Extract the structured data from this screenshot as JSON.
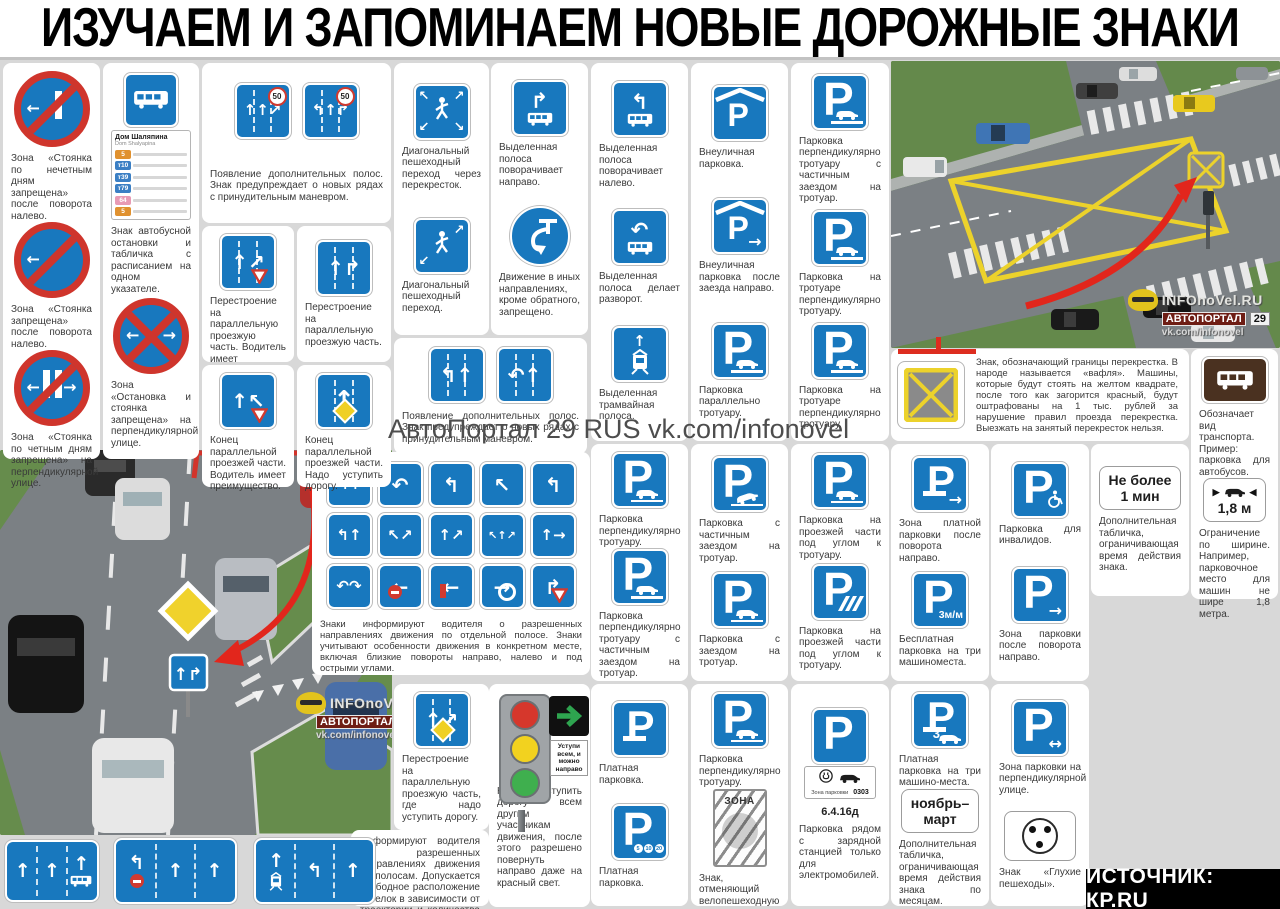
{
  "title": "ИЗУЧАЕМ И ЗАПОМИНАЕМ НОВЫЕ ДОРОЖНЫЕ ЗНАКИ",
  "source_bar": "ИСТОЧНИК: КР.RU",
  "watermark": {
    "brand": "АвтоПортал 29 RUS vk.com/infonovel"
  },
  "photo_watermark": {
    "line1": "INFOnoVel.RU",
    "chip1": "АВТОПОРТАЛ",
    "chip2": "29",
    "line3": "vk.com/infonovel"
  },
  "colors": {
    "sign_blue": "#1878be",
    "sign_red": "#cf352c",
    "waffle_yellow": "#ecd22b",
    "background": "#d8d8d8"
  },
  "bus_stop": {
    "title": "Дом Шаляпина",
    "subtitle": "Dom Shalyapina",
    "routes": [
      {
        "label": "5",
        "color": "#e0912f"
      },
      {
        "label": "т10",
        "color": "#3b7fc4"
      },
      {
        "label": "т39",
        "color": "#3b7fc4"
      },
      {
        "label": "т79",
        "color": "#3b7fc4"
      },
      {
        "label": "64",
        "color": "#e89ab4"
      },
      {
        "label": "5",
        "color": "#e0912f"
      }
    ]
  },
  "texts": {
    "waffle": "Знак, обозначающий границы перекрестка. В народе называется «вафля». Машины, которые будут стоять на желтом квадрате, после того как загорится красный, будут оштрафованы на 1 тыс. рублей за нарушение правил проезда перекрестка. Выезжать на занятый перекресток нельзя.",
    "lane_info": "Информируют водителя о разрешенных направлениях движения по полосам. Допускается свободное расположение стрелок в зависимости от траектории и количества направлений движения из полосы."
  },
  "cluster": {
    "text": "Знаки информируют водителя о разрешенных направлениях движения по отдельной полосе. Знаки учитывают особенности движения в конкретном месте, включая близкие повороты направо, налево и под острыми углами.",
    "items": [
      {
        "g": "↰↑"
      },
      {
        "g": "↶"
      },
      {
        "g": "↰"
      },
      {
        "g": "↖"
      },
      {
        "g": "↰"
      },
      {
        "g": "↰↑"
      },
      {
        "g": "↖↗"
      },
      {
        "g": "↑↗"
      },
      {
        "g": "↖↑↗"
      },
      {
        "g": "↑→"
      },
      {
        "g": "↶↷"
      },
      {
        "g": "←",
        "ex": [
          "noentry"
        ]
      },
      {
        "g": "←",
        "ex": [
          "stopbar"
        ]
      },
      {
        "g": "→",
        "ex": [
          "ring"
        ]
      },
      {
        "g": "↱",
        "ex": [
          "yield"
        ]
      }
    ]
  },
  "traffic_light": {
    "plate": "Уступи всем, и можно направо",
    "caption": "Нужно уступить дорогу всем другим участникам движения, после этого разрешено повернуть направо даже на красный свет.",
    "light_colors": [
      "#d6372c",
      "#f2d21f",
      "#3faf4e"
    ]
  },
  "bottom_signs": [
    {
      "x": 5,
      "y": 840,
      "w": 94,
      "h": 62,
      "cols": [
        {
          "g": "↑"
        },
        {
          "g": "↑"
        },
        {
          "g": "↑",
          "bus": true
        }
      ]
    },
    {
      "x": 114,
      "y": 838,
      "w": 123,
      "h": 66,
      "cols": [
        {
          "g": "↰",
          "ex": [
            "noentry"
          ]
        },
        {
          "g": "↑"
        },
        {
          "g": "↑"
        }
      ]
    },
    {
      "x": 254,
      "y": 838,
      "w": 121,
      "h": 66,
      "cols": [
        {
          "g": "↑",
          "tram": true
        },
        {
          "g": "↰"
        },
        {
          "g": "↑"
        }
      ]
    }
  ],
  "cards": [
    {
      "id": "zone-parking-left",
      "x": 3,
      "y": 63,
      "w": 97,
      "h": 396,
      "items": [
        {
          "kind": "round",
          "bars": 1,
          "arrows": "l",
          "name": "no-parking-odd-days-sign",
          "caption": "Зона «Стоянка по нечетным дням запрещена» после поворота налево."
        },
        {
          "kind": "round",
          "bars": 0,
          "arrows": "l",
          "name": "no-parking-sign",
          "caption": "Зона «Стоянка запрещена» после поворота налево."
        },
        {
          "kind": "round",
          "bars": 2,
          "arrows": "lr",
          "name": "no-parking-even-days-sign",
          "caption": "Зона «Стоянка по четным дням запрещена» на перпендикулярной улице."
        }
      ]
    },
    {
      "id": "bus-stop",
      "x": 103,
      "y": 63,
      "w": 96,
      "h": 396,
      "items": [
        {
          "kind": "busstop",
          "name": "bus-stop-sign",
          "caption": "Знак автобусной остановки и табличка с расписанием на одном указателе."
        },
        {
          "kind": "round",
          "bars": 0,
          "cross": true,
          "arrows": "lr",
          "name": "no-stopping-sign",
          "caption": "Зона «Остановка и стоянка запрещена» на перпендикулярной улице."
        }
      ]
    },
    {
      "id": "extra-lanes-1",
      "x": 202,
      "y": 63,
      "w": 189,
      "h": 160,
      "signs": [
        {
          "kind": "sq",
          "g": "↑↑↗",
          "ex": [
            "lanes",
            "50"
          ],
          "name": "extra-lane-sign"
        },
        {
          "kind": "sq",
          "g": "↰↑↱",
          "ex": [
            "lanes",
            "50"
          ],
          "name": "extra-lane-sign"
        }
      ],
      "caption": "Появление дополнительных полос. Знак предупреждает о новых рядах с принудительным маневром."
    },
    {
      "id": "merge-priority",
      "x": 202,
      "y": 226,
      "w": 92,
      "h": 136,
      "items": [
        {
          "kind": "sq",
          "g": "↑↗",
          "ex": [
            "lanes",
            "yield"
          ],
          "name": "merge-parallel-sign",
          "caption": "Перестроение на параллельную проезжую часть. Водитель имеет преимущество."
        }
      ]
    },
    {
      "id": "merge-plain",
      "x": 297,
      "y": 226,
      "w": 94,
      "h": 136,
      "items": [
        {
          "kind": "sq",
          "g": "↑↱",
          "ex": [
            "lanes"
          ],
          "name": "merge-parallel-sign",
          "caption": "Перестроение на параллельную проезжую часть."
        }
      ]
    },
    {
      "id": "end-parallel-priority",
      "x": 202,
      "y": 365,
      "w": 92,
      "h": 122,
      "items": [
        {
          "kind": "sq",
          "g": "↑↖",
          "ex": [
            "yield"
          ],
          "name": "end-parallel-sign",
          "caption": "Конец параллельной проезжей части. Водитель имеет преимущество."
        }
      ]
    },
    {
      "id": "end-parallel-yield",
      "x": 297,
      "y": 365,
      "w": 94,
      "h": 122,
      "items": [
        {
          "kind": "sq",
          "g": "↑",
          "ex": [
            "lanes",
            "diamond"
          ],
          "name": "end-parallel-sign",
          "caption": "Конец параллельной проезжей части. Надо уступить дорогу."
        }
      ]
    },
    {
      "id": "diag-crossings",
      "x": 394,
      "y": 63,
      "w": 95,
      "h": 272,
      "items": [
        {
          "kind": "ped",
          "four": true,
          "name": "diagonal-crossing-sign",
          "caption": "Диагональный пешеходный переход через перекресток."
        },
        {
          "kind": "ped",
          "four": false,
          "name": "diagonal-crossing-sign",
          "caption": "Диагональный пешеходный переход."
        }
      ]
    },
    {
      "id": "extra-lanes-2",
      "x": 394,
      "y": 338,
      "w": 193,
      "h": 116,
      "signs": [
        {
          "kind": "sq",
          "g": "↰↑",
          "ex": [
            "lanes"
          ],
          "name": "extra-lane-sign"
        },
        {
          "kind": "sq",
          "g": "↶↑",
          "ex": [
            "lanes"
          ],
          "name": "extra-lane-sign"
        }
      ],
      "caption": "Появление дополнительных полос. Знак предупреждает о новых рядах с принудительным маневром."
    },
    {
      "id": "bus-lane-right",
      "x": 491,
      "y": 63,
      "w": 97,
      "h": 272,
      "items": [
        {
          "kind": "busturn",
          "g": "↱",
          "name": "bus-lane-turn-sign",
          "caption": "Выделенная полоса поворачивает направо."
        },
        {
          "kind": "uturn",
          "name": "mandatory-uturn-sign",
          "caption": "Движение в иных направлениях, кроме обратного, запрещено."
        }
      ]
    },
    {
      "id": "bus-lane-left",
      "x": 591,
      "y": 63,
      "w": 97,
      "h": 378,
      "items": [
        {
          "kind": "busturn",
          "g": "↰",
          "name": "bus-lane-turn-sign",
          "caption": "Выделенная полоса поворачивает налево."
        },
        {
          "kind": "busturn",
          "g": "↶",
          "name": "bus-lane-uturn-sign",
          "caption": "Выделенная полоса делает разворот."
        },
        {
          "kind": "tramlane",
          "name": "tram-lane-sign",
          "caption": "Выделенная трамвайная полоса."
        }
      ]
    },
    {
      "id": "offstreet-parking",
      "x": 691,
      "y": 63,
      "w": 97,
      "h": 378,
      "items": [
        {
          "kind": "p",
          "roof": true,
          "name": "offstreet-parking-sign",
          "caption": "Внеуличная парковка."
        },
        {
          "kind": "p",
          "roof": true,
          "arr": "→",
          "name": "offstreet-parking-right-sign",
          "caption": "Внеуличная парковка после заезда направо."
        },
        {
          "kind": "p",
          "car": "side",
          "name": "parallel-parking-sign",
          "caption": "Парковка параллельно тротуару."
        }
      ]
    },
    {
      "id": "sidewalk-parking",
      "x": 791,
      "y": 63,
      "w": 98,
      "h": 378,
      "items": [
        {
          "kind": "p",
          "car": "curb",
          "name": "parking-sign",
          "caption": "Парковка перпендикулярно тротуару с частичным заездом на тротуар."
        },
        {
          "kind": "p",
          "car": "curb",
          "name": "parking-sign",
          "caption": "Парковка на тротуаре перпендикулярно тротуару."
        },
        {
          "kind": "p",
          "car": "curb",
          "name": "parking-sign",
          "caption": "Парковка на тротуаре перпендикулярно тротуару."
        }
      ]
    },
    {
      "id": "parking-mid-1",
      "x": 591,
      "y": 444,
      "w": 97,
      "h": 237,
      "items": [
        {
          "kind": "p",
          "car": "flat",
          "name": "parking-sign",
          "caption": "Парковка перпендикулярно тротуару."
        },
        {
          "kind": "p",
          "car": "curb",
          "name": "parking-sign",
          "caption": "Парковка перпендикулярно тротуару с частичным заездом на тротуар."
        }
      ]
    },
    {
      "id": "parking-mid-2",
      "x": 691,
      "y": 444,
      "w": 97,
      "h": 237,
      "items": [
        {
          "kind": "p",
          "car": "angle",
          "name": "parking-sign",
          "caption": "Парковка с частичным заездом на тротуар."
        },
        {
          "kind": "p",
          "car": "flat",
          "name": "parking-sign",
          "caption": "Парковка с заездом на тротуар."
        }
      ]
    },
    {
      "id": "parking-mid-3",
      "x": 791,
      "y": 444,
      "w": 98,
      "h": 237,
      "items": [
        {
          "kind": "p",
          "car": "curb",
          "name": "parking-sign",
          "caption": "Парковка на проезжей части под углом к тротуару."
        },
        {
          "kind": "p",
          "stripes": true,
          "name": "parking-angle-sign",
          "caption": "Парковка на проезжей части под углом к тротуару."
        }
      ]
    },
    {
      "id": "paid-zone",
      "x": 891,
      "y": 444,
      "w": 98,
      "h": 237,
      "items": [
        {
          "kind": "p",
          "rub": true,
          "arr": "→",
          "name": "paid-parking-zone-sign",
          "caption": "Зона платной парковки после поворота направо."
        },
        {
          "kind": "p",
          "m3": true,
          "name": "free-parking-sign",
          "caption": "Бесплатная парковка на три машиноместа."
        }
      ]
    },
    {
      "id": "disabled-parking",
      "x": 991,
      "y": 444,
      "w": 98,
      "h": 237,
      "items": [
        {
          "kind": "p",
          "dis": true,
          "name": "disabled-parking-sign",
          "caption": "Парковка для инвалидов."
        },
        {
          "kind": "p",
          "arr": "→",
          "name": "parking-zone-right-sign",
          "caption": "Зона парковки после поворота направо."
        }
      ]
    },
    {
      "id": "time-plate",
      "x": 1091,
      "y": 444,
      "w": 98,
      "h": 152,
      "items": [
        {
          "kind": "plate",
          "lines": [
            "Не более",
            "1 мин"
          ],
          "name": "time-limit-plate",
          "caption": "Дополнительная табличка, ограничивающая время действия знака."
        }
      ]
    },
    {
      "id": "paid-parking",
      "x": 591,
      "y": 684,
      "w": 97,
      "h": 222,
      "items": [
        {
          "kind": "p",
          "rub": true,
          "name": "paid-parking-sign",
          "caption": "Платная парковка."
        },
        {
          "kind": "p",
          "coins": true,
          "name": "paid-parking-sign",
          "caption": "Платная парковка."
        }
      ]
    },
    {
      "id": "zona-cancel",
      "x": 691,
      "y": 684,
      "w": 97,
      "h": 222,
      "items": [
        {
          "kind": "p",
          "car": "flat",
          "name": "parking-sign",
          "caption": "Парковка перпендикулярно тротуару."
        },
        {
          "kind": "zona",
          "zona_label": "ЗОНА",
          "name": "zone-end-sign",
          "caption": "Знак, отменяющий велопешеходную зону."
        }
      ]
    },
    {
      "id": "ev-parking",
      "x": 791,
      "y": 684,
      "w": 98,
      "h": 222,
      "items": [
        {
          "kind": "pev",
          "label": "6.4.16д",
          "plate_text": "Зона парковки",
          "plate_num": "0303",
          "name": "ev-charging-parking-sign",
          "caption": "Парковка рядом с зарядной станцией только для электромобилей."
        }
      ]
    },
    {
      "id": "paid-3places",
      "x": 891,
      "y": 684,
      "w": 98,
      "h": 222,
      "items": [
        {
          "kind": "p",
          "rub": true,
          "three": true,
          "name": "paid-parking-3-sign",
          "caption": "Платная парковка на три машино-места."
        },
        {
          "kind": "plate",
          "lines": [
            "ноябрь–",
            "март"
          ],
          "name": "months-plate",
          "caption": "Дополнительная табличка, ограничивающая время действия знака по месяцам."
        }
      ]
    },
    {
      "id": "perp-street",
      "x": 991,
      "y": 684,
      "w": 98,
      "h": 222,
      "items": [
        {
          "kind": "p",
          "arr": "↔",
          "name": "parking-zone-perpendicular-sign",
          "caption": "Зона парковки на перпендикулярной улице."
        },
        {
          "kind": "dots",
          "name": "deaf-pedestrians-sign",
          "caption": "Знак «Глухие пешеходы»."
        }
      ]
    },
    {
      "id": "vehicle-type",
      "x": 1191,
      "y": 349,
      "w": 87,
      "h": 250,
      "items": [
        {
          "kind": "brownbus",
          "name": "bus-type-plate",
          "caption": "Обозначает вид транспорта. Пример: парковка для автобусов."
        },
        {
          "kind": "plate18",
          "width_label": "1,8 м",
          "name": "width-limit-plate",
          "caption": "Ограничение по ширине. Например, парковочное место для машин не шире 1,8 метра."
        }
      ]
    },
    {
      "id": "merge-yield-diamond",
      "x": 394,
      "y": 684,
      "w": 95,
      "h": 146,
      "items": [
        {
          "kind": "sq",
          "g": "↑↗",
          "ex": [
            "lanes",
            "diamondc"
          ],
          "name": "merge-yield-sign",
          "caption": "Перестроение на параллельную проезжую часть, где надо уступить дорогу."
        }
      ]
    },
    {
      "id": "lane-info-text",
      "x": 351,
      "y": 830,
      "w": 138,
      "h": 76,
      "text": "lane_info"
    }
  ],
  "waffle_card": {
    "x": 891,
    "y": 349,
    "w": 298,
    "h": 90
  }
}
